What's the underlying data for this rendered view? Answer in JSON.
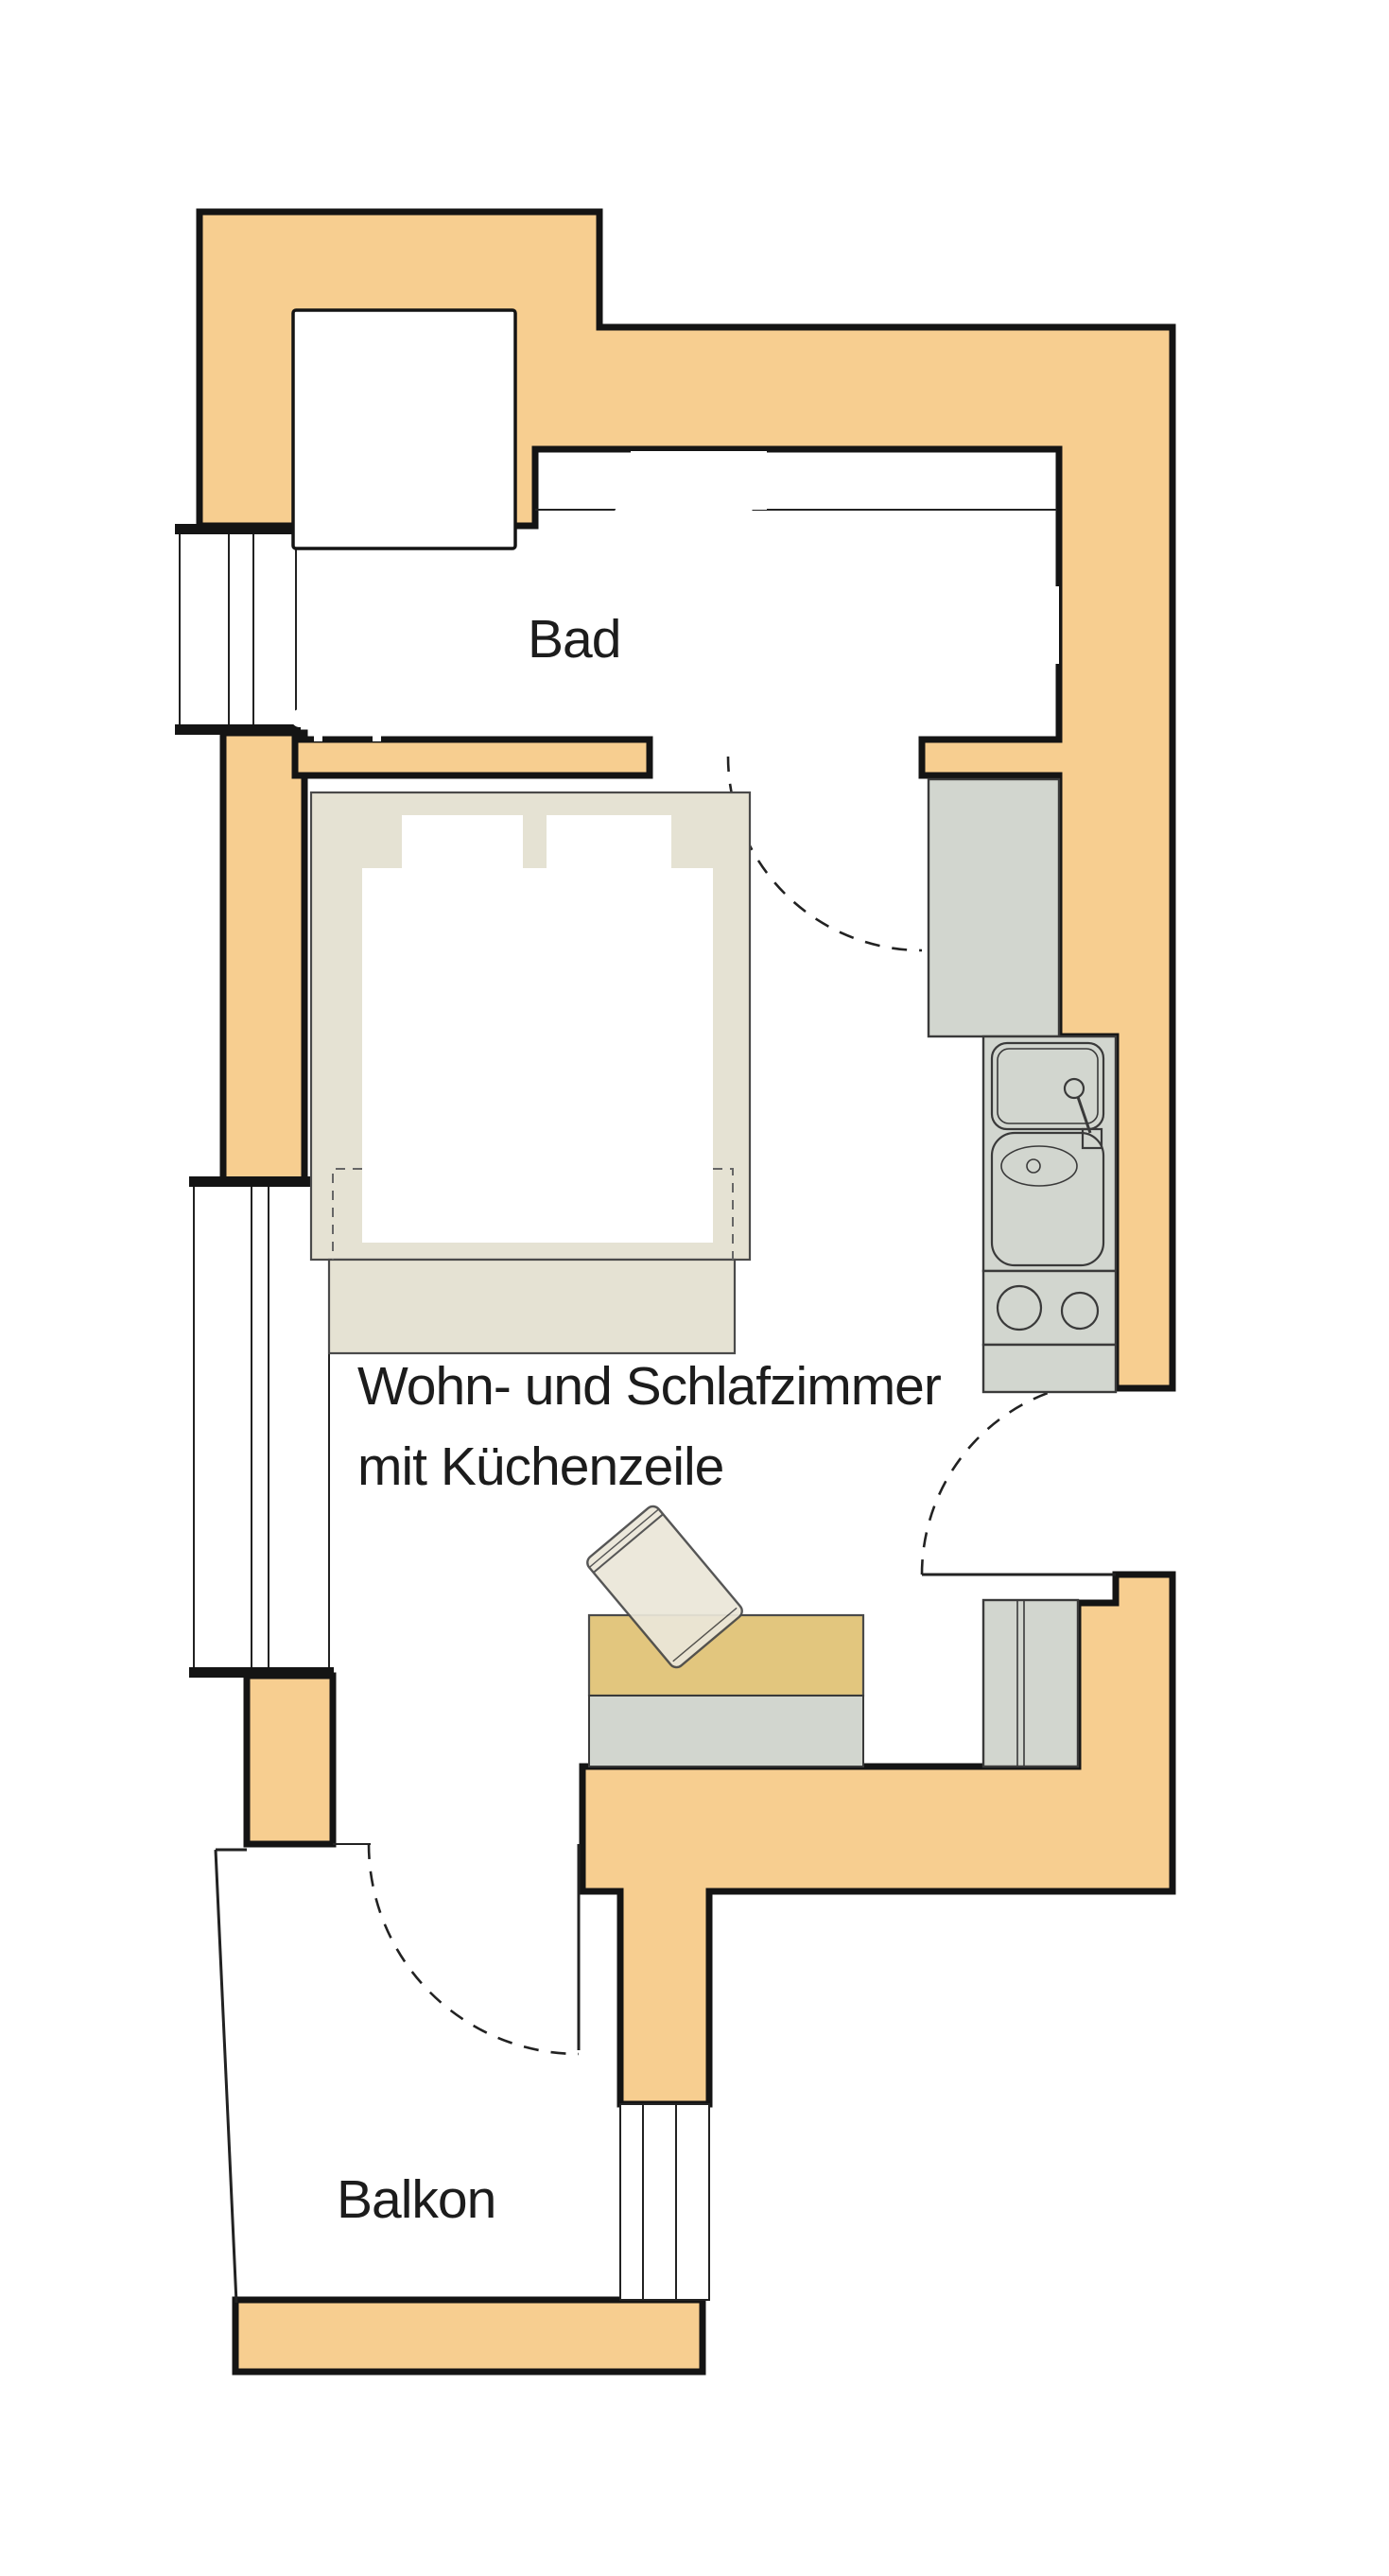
{
  "labels": {
    "bathroom": "Bad",
    "living_line1": "Wohn- und Schlafzimmer",
    "living_line2": "mit Küchenzeile",
    "balcony": "Balkon"
  },
  "colors": {
    "paper": "#FFFFFF",
    "wall": "#F7CE90",
    "wall_outline": "#141414",
    "line_thin": "#222222",
    "unit_gray": "#D2D6CF",
    "unit_stroke": "#3A3A3A",
    "furniture_beige": "#E5E2D3",
    "furniture_stroke": "#4A4A4A",
    "table_tan": "#E2C67E",
    "chair_fill": "#EBE7D9",
    "text": "#1C1C1C"
  }
}
